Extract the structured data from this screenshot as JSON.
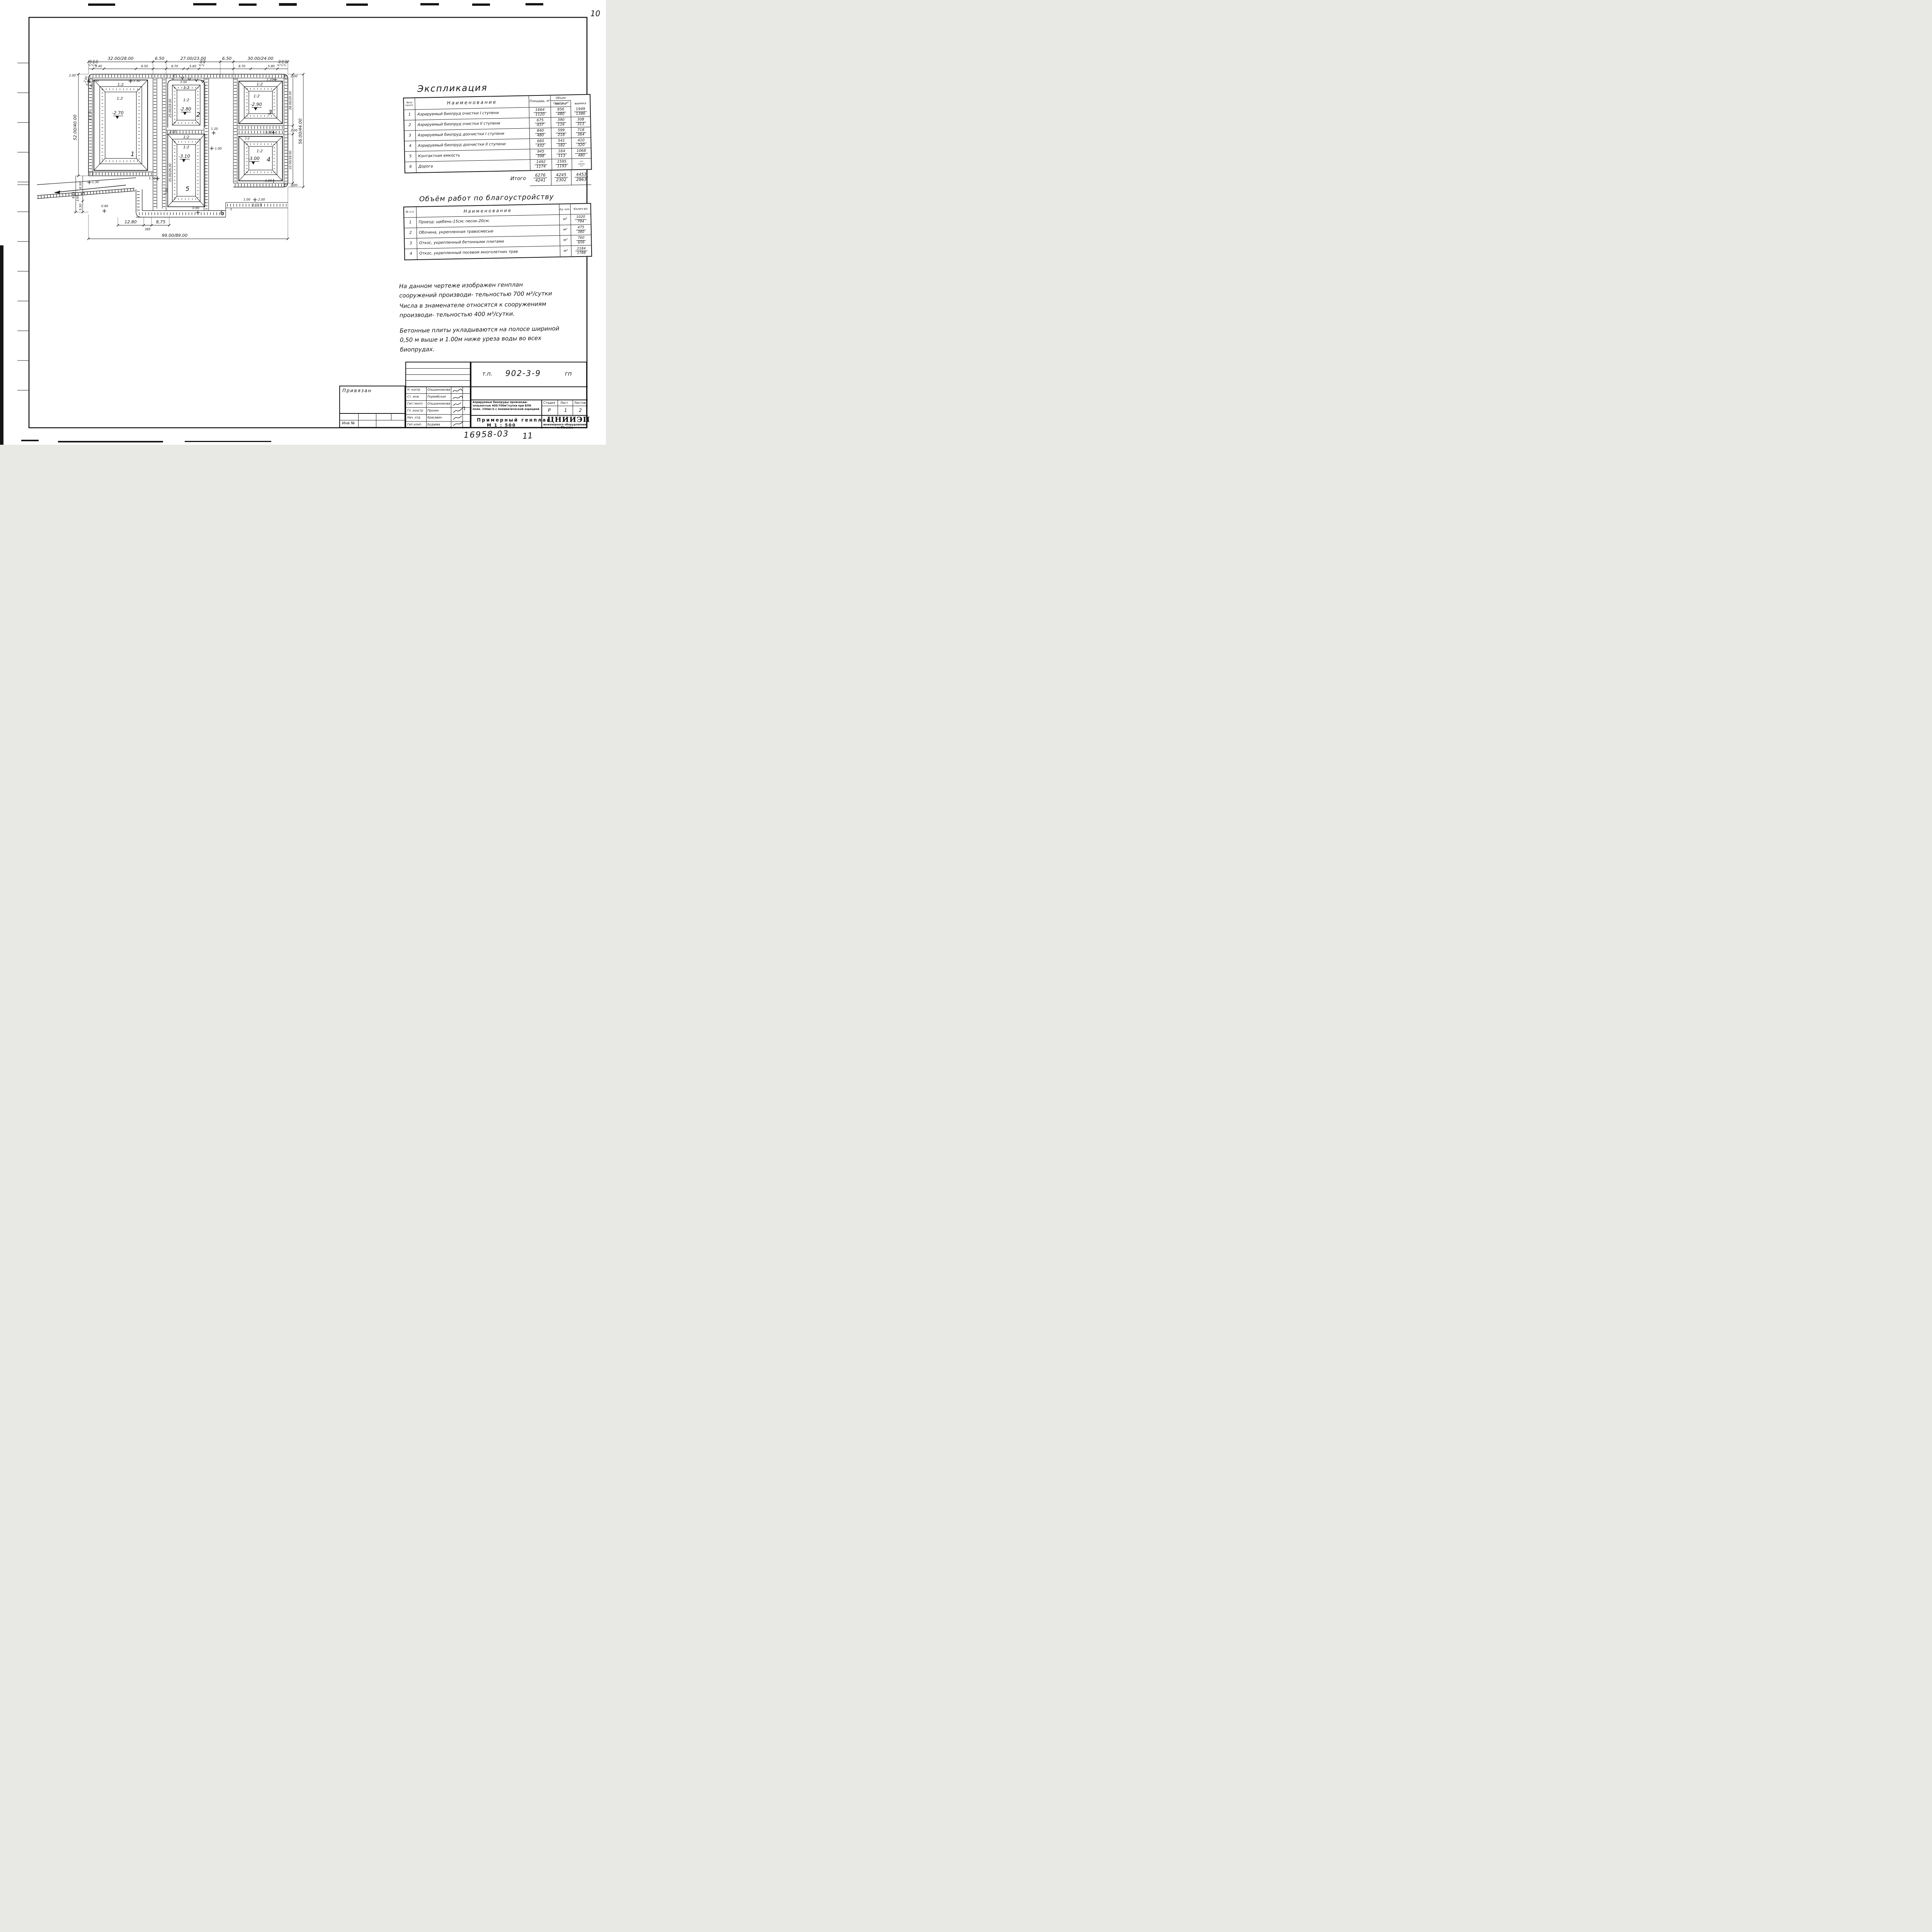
{
  "page": {
    "number": "10",
    "doc_number": "16958-03",
    "extra_number": "11"
  },
  "titles": {
    "ekspl": "Экспликация",
    "works": "Объём работ по благоустройству"
  },
  "ekspl": {
    "col_num": "№по генпл.",
    "col_name": "Наименование",
    "col_area": "Площадь, м²",
    "col_soil": "Объем грунта, м³",
    "col_fill": "насыпь",
    "col_cut": "выемка",
    "rows": [
      {
        "n": "1",
        "name": "Аэрируемый биопруд очистки I ступени",
        "a1": "1664",
        "a2": "1120",
        "f1": "956",
        "f2": "480",
        "c1": "1949",
        "c2": "1386"
      },
      {
        "n": "2",
        "name": "Аэрируемый биопруд очистки II ступени",
        "a1": "675",
        "a2": "437",
        "f1": "390",
        "f2": "116",
        "c1": "308",
        "c2": "313"
      },
      {
        "n": "3",
        "name": "Аэрируемый биопруд доочистки I ступени",
        "a1": "840",
        "a2": "480",
        "f1": "599",
        "f2": "218",
        "c1": "718",
        "c2": "364"
      },
      {
        "n": "4",
        "name": "Аэрируемый биопруд доочистки II ступени",
        "a1": "660",
        "a2": "432",
        "f1": "541",
        "f2": "182",
        "c1": "410",
        "c2": "320"
      },
      {
        "n": "5",
        "name": "Контактная емкость",
        "a1": "945",
        "a2": "598",
        "f1": "164",
        "f2": "113",
        "c1": "1068",
        "c2": "480"
      },
      {
        "n": "6",
        "name": "Дорога",
        "a1": "1492",
        "a2": "1174",
        "f1": "1595",
        "f2": "1193",
        "c1": "—",
        "c2": "—"
      }
    ],
    "total_label": "Итого",
    "t_a1": "6276",
    "t_a2": "4241",
    "t_f1": "4245",
    "t_f2": "2302",
    "t_c1": "4453",
    "t_c2": "2863"
  },
  "works": {
    "col_num": "№ п.п.",
    "col_name": "Наименование",
    "col_unit": "Ед. изм.",
    "col_qty": "Колич-во",
    "rows": [
      {
        "n": "1",
        "name": "Проезд: щебень-15см; песок-20см.",
        "unit": "м²",
        "q1": "1020",
        "q2": "794"
      },
      {
        "n": "2",
        "name": "Обочина, укрепленная травосмесью",
        "unit": "м²",
        "q1": "475",
        "q2": "380"
      },
      {
        "n": "3",
        "name": "Откос, укрепленный бетонными плитами",
        "unit": "м²",
        "q1": "760",
        "q2": "656"
      },
      {
        "n": "4",
        "name": "Откос, укрепленный посевом многолетних трав",
        "unit": "м²",
        "q1": "2184",
        "q2": "1788"
      }
    ]
  },
  "notes": {
    "n1": "На данном чертеже изображен генплан сооружений производи- тельностью 700 м³/сутки",
    "n2": "Числа в знаменателе относятся к сооружениям производи- тельностью 400 м³/сутки.",
    "n3": "Бетонные плиты укладываются на полосе шириной 0,50 м выше и 1.00м ниже уреза воды во всех биопрудах."
  },
  "stamp": {
    "tp_label": "т.п.",
    "tp_code": "902-3-9",
    "tp_right": "гп",
    "project": "Аэрируемые биопруды производи- тельностью 400:700м³/сутки при БПК полн. 150мг/л с пневматической аэрацией",
    "drawing_title": "Примерный генплан",
    "scale": "М 1 : 500",
    "stage_label": "Стадия",
    "sheet_label": "Лист",
    "sheets_label": "Листов",
    "stage": "Р",
    "sheet": "1",
    "sheets": "2",
    "org_name": "ЦНИИЭП",
    "org_sub": "инженерного оборудования",
    "org_city": "г. Москва",
    "bound_label": "Привязан",
    "inv_label": "Инв №",
    "roles": [
      {
        "role": "Н. контр",
        "name": "Ольшанникова"
      },
      {
        "role": "Ст. инж",
        "name": "Порембская"
      },
      {
        "role": "Гип генпл",
        "name": "Ольшанникова"
      },
      {
        "role": "Гл. констр",
        "name": "Пронин"
      },
      {
        "role": "Нач. отд",
        "name": "Красавин"
      },
      {
        "role": "Гип комп.",
        "name": "Будаева"
      }
    ]
  },
  "plan": {
    "dims_top_main": [
      "32.00/28.00",
      "6.50",
      "27.00/23.00",
      "6.50",
      "30.00/24.00"
    ],
    "dims_top_small": [
      "5.40",
      "8.50",
      "8.70",
      "5.60",
      "8.70",
      "5.80"
    ],
    "dims_top_tiny": [
      "2.00",
      "2.60",
      "0.50",
      "0.50",
      "2.40",
      "0.50",
      "2.20",
      "2.00"
    ],
    "dims_left": {
      "band": "2.00",
      "tiny": [
        "2.60",
        "0.50",
        "5.40"
      ],
      "main": "52.00/40.00",
      "sub": [
        "8.50",
        "3.95",
        "5.50",
        "9.45"
      ]
    },
    "dims_right": {
      "r3": "28.00/20.00",
      "r4": "22.00/18.00",
      "main": "56.00/44.00",
      "band": "2.00"
    },
    "dims_bottom": [
      "12.80",
      "385",
      "8,75",
      "99.00/89.00"
    ],
    "dims_mid": {
      "p2": "25.00/19.00",
      "p5": "35.00/26.00",
      "gap": "2.00",
      "d35": "3.50",
      "d45": "4.50",
      "d55": "5.50"
    },
    "marks": {
      "m130": "1.30",
      "m110": "1.10",
      "m120": "1.20",
      "m100": "1.00",
      "m090": "0.90",
      "m200": "2.00"
    },
    "slopes": {
      "main": "1:2",
      "outer": "1:1.5"
    },
    "levels": [
      "-2.70",
      "-2.80",
      "-2.90",
      "-3.00",
      "-3.10"
    ],
    "labels": [
      "1",
      "2",
      "3",
      "4",
      "5",
      "6"
    ]
  }
}
